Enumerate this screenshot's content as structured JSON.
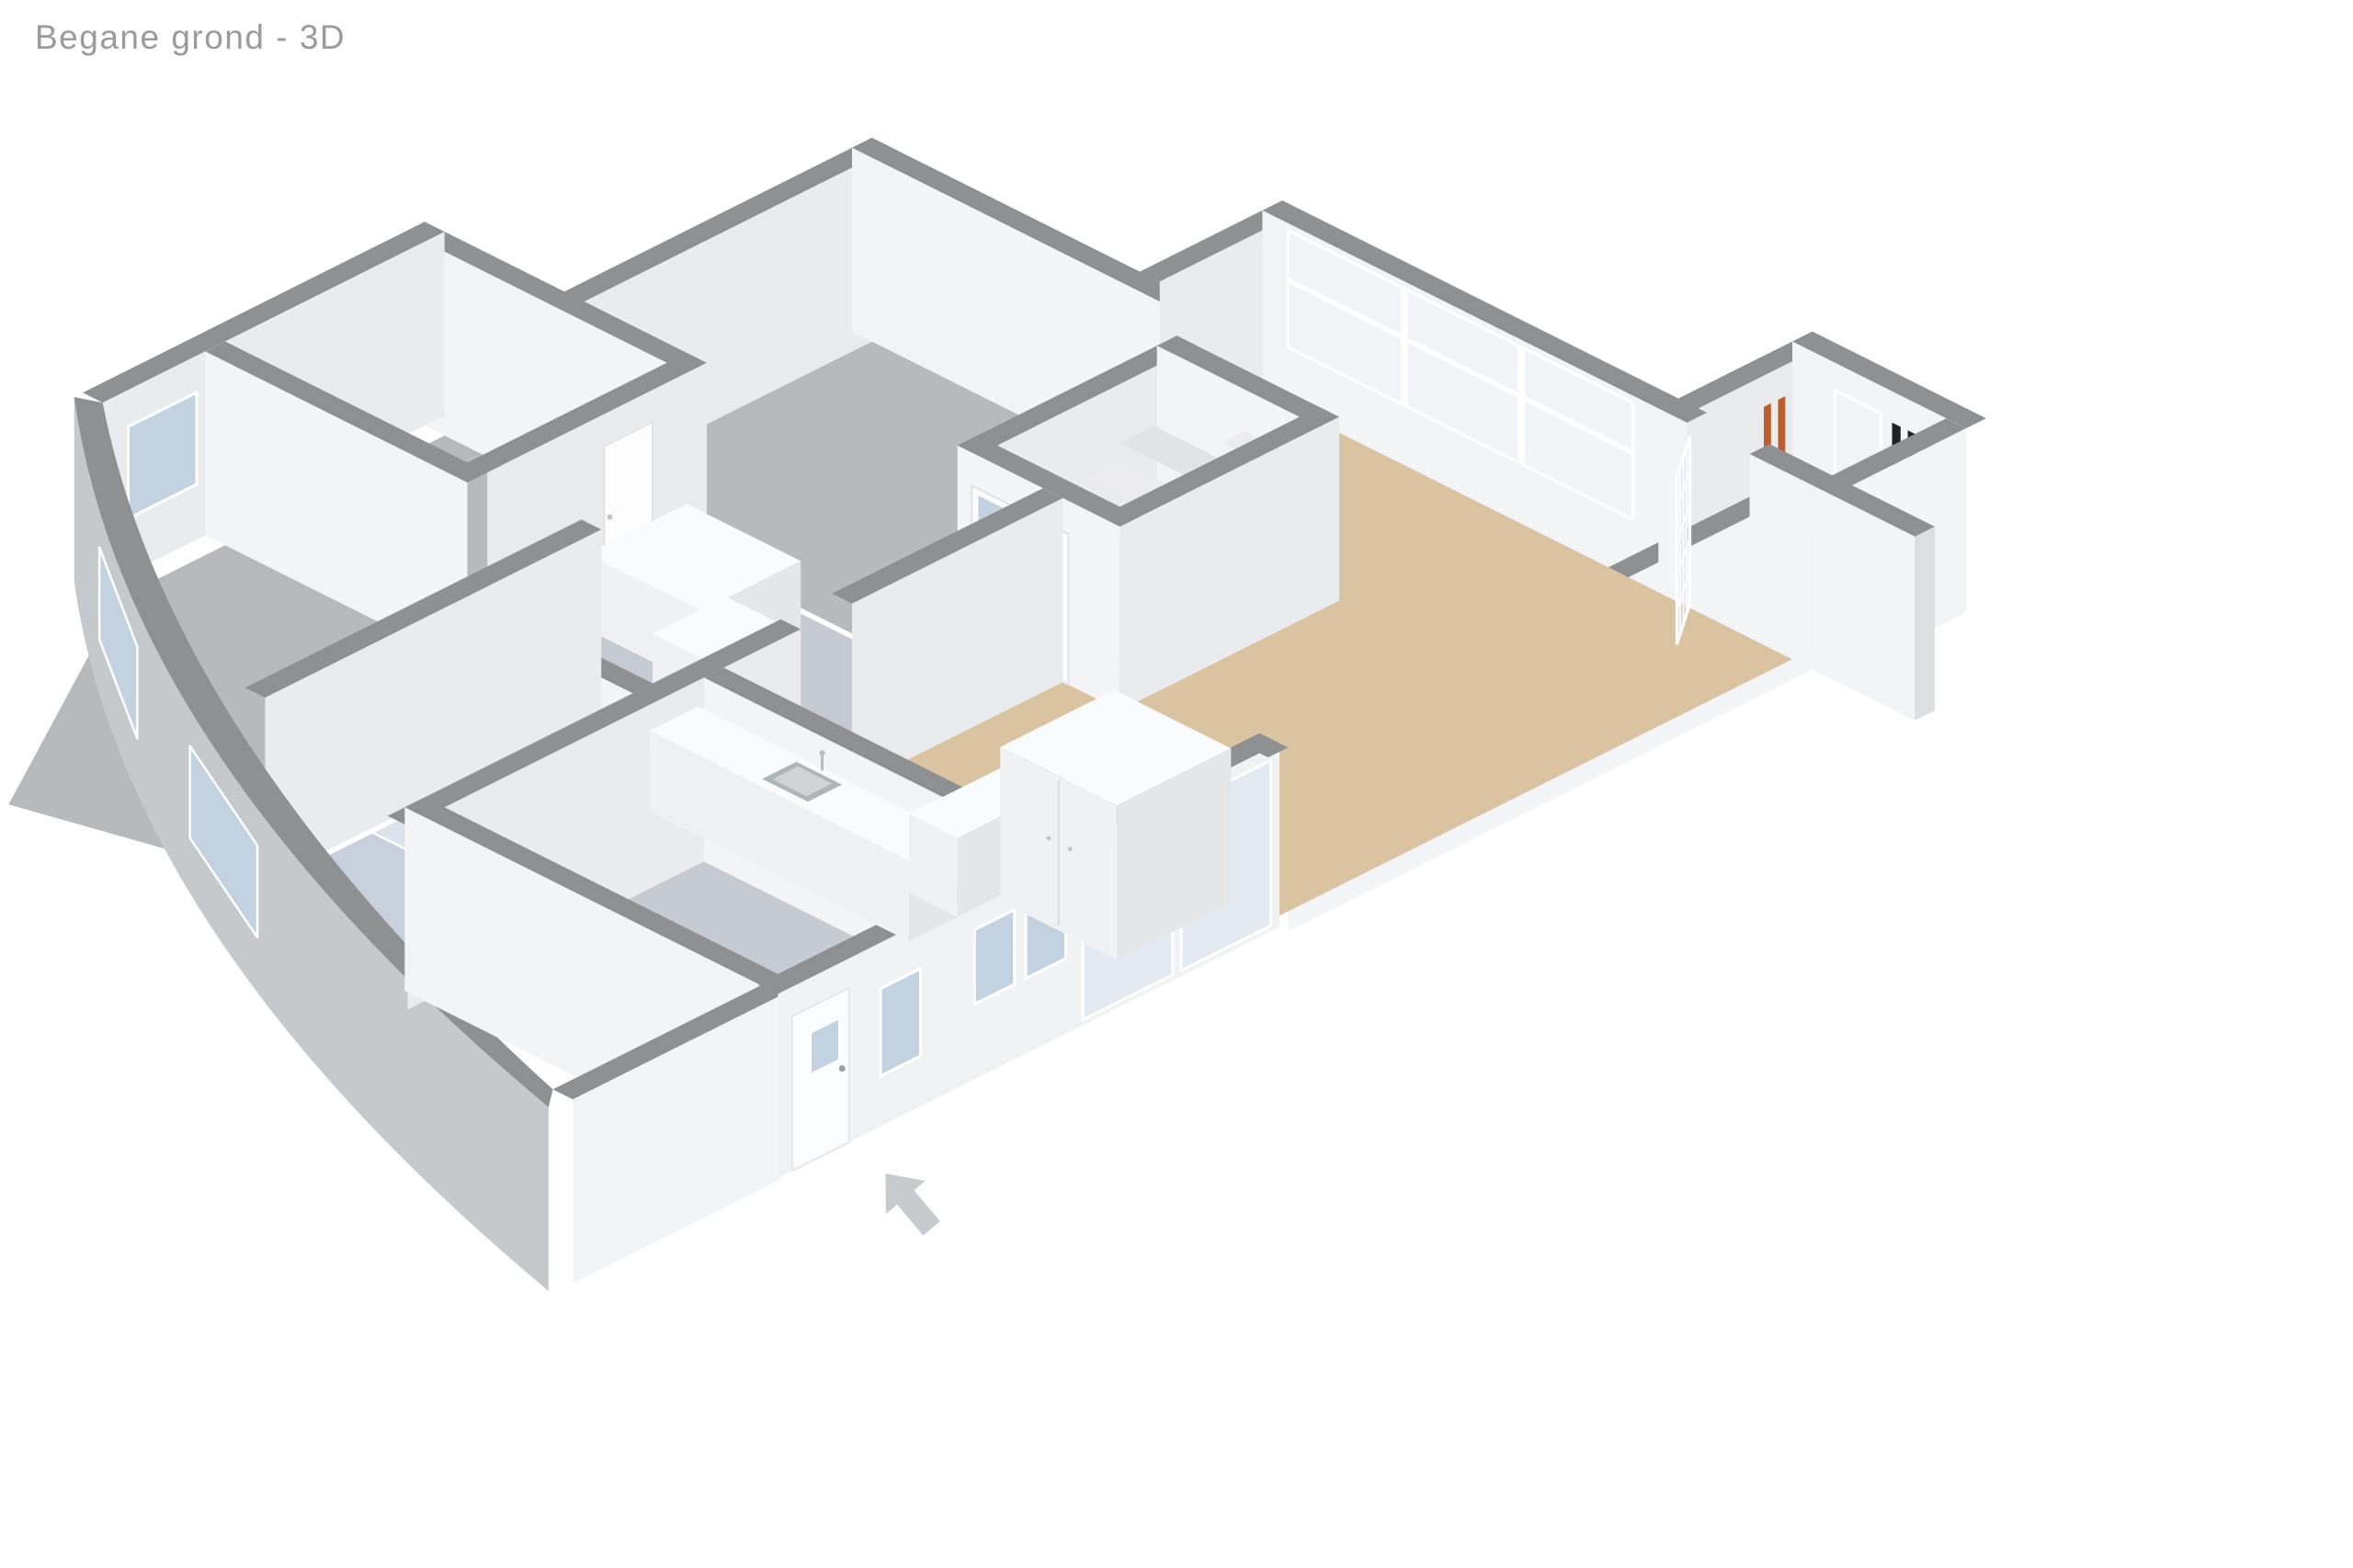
{
  "page": {
    "background": "#ffffff"
  },
  "header": {
    "title": "Begane grond - 3D"
  },
  "floorplan": {
    "view_mode": "3D",
    "icons": {
      "entrance_arrow": "arrow-pointing-to-front-door"
    },
    "colors": {
      "background": "#ffffff",
      "title_text": "#9b9b9b",
      "wall_top": "#8e9091",
      "wall_face": "#f3f4f5",
      "wall_face_side": "#e9ebec",
      "curve_ext": "#c6c9cb",
      "floor_living": "#d9c3a0",
      "floor_room": "#b7b9bb",
      "floor_bath": "#c7d0dc",
      "floor_hall": "#c6cbd3",
      "glass_blue": "#c3d2e0",
      "glass_clear": "rgba(216,228,238,0.55)",
      "glass_white": "#f0f4f7",
      "frame": "#ffffff",
      "tread": "#ececee",
      "tread_alt": "#e1e3e5",
      "cooktop": "#161616",
      "burner": "#d2271b",
      "sink": "#aeb4b8",
      "meter_dark": "#222222",
      "meter_orange": "#bf5c2b",
      "arrow": "#c8cbce"
    }
  }
}
